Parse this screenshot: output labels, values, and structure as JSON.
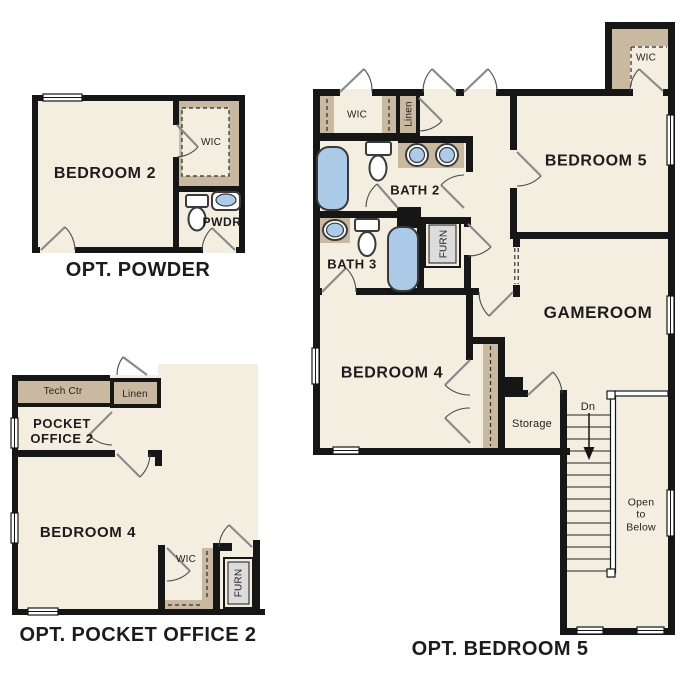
{
  "colors": {
    "background": "#ffffff",
    "wall": "#161616",
    "room": "#f4eee0",
    "closet": "#c9b9a1",
    "fixture": "#abcbe8",
    "fixture_stroke": "#3a3a3a",
    "furnace": "#dcdcdc",
    "door": "#8a8a8a",
    "text": "#1c1c1c"
  },
  "plans": {
    "opt_powder": {
      "title": "OPT. POWDER",
      "rooms": {
        "bedroom2": "BEDROOM 2",
        "wic": "WIC",
        "pwdr": "PWDR"
      }
    },
    "opt_pocket_office_2": {
      "title": "OPT. POCKET OFFICE 2",
      "rooms": {
        "tech_ctr": "Tech Ctr",
        "linen": "Linen",
        "pocket_office_line1": "POCKET",
        "pocket_office_line2": "OFFICE 2",
        "bedroom4": "BEDROOM 4",
        "wic": "WIC",
        "furn": "FURN"
      }
    },
    "opt_bedroom_5": {
      "title": "OPT. BEDROOM 5",
      "rooms": {
        "wic_hall": "WIC",
        "linen": "Linen",
        "bath2": "BATH 2",
        "bedroom5": "BEDROOM 5",
        "wic_bedroom5": "WIC",
        "bath3": "BATH 3",
        "furn": "FURN",
        "gameroom": "GAMEROOM",
        "bedroom4": "BEDROOM 4",
        "storage": "Storage",
        "stairs_dn": "Dn",
        "open_below_line1": "Open",
        "open_below_line2": "to",
        "open_below_line3": "Below"
      }
    }
  }
}
